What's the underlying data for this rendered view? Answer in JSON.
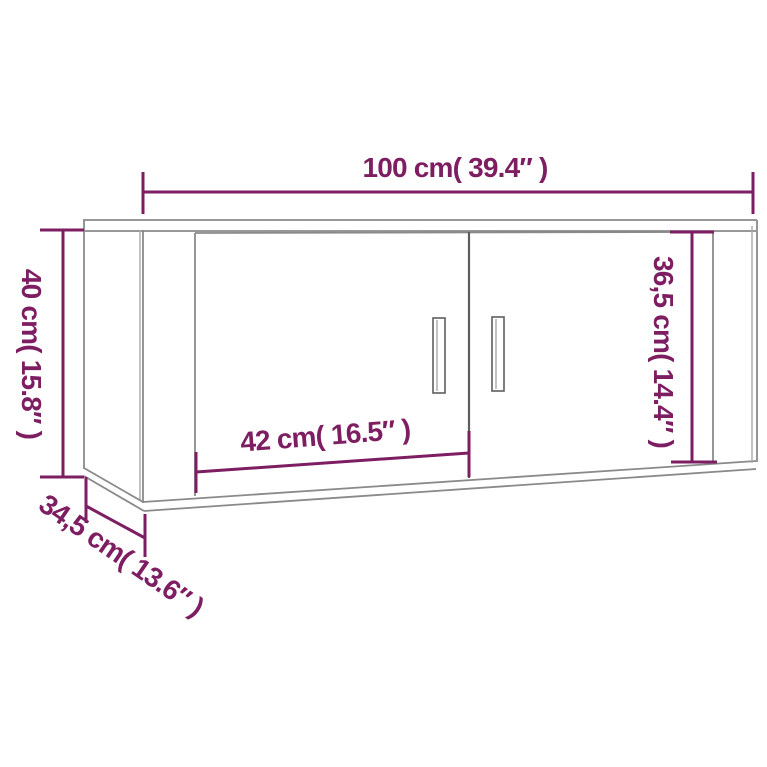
{
  "image": {
    "title": "Wall cabinet dimension diagram",
    "background": "#ffffff"
  },
  "colors": {
    "accent": "#7e1e62",
    "outline": "#8a8a8a",
    "outline_dark": "#5e5e5e"
  },
  "dimensions": {
    "width": {
      "label": "100 cm( 39.4″ )"
    },
    "height": {
      "label": "40 cm( 15.8″ )"
    },
    "door_height": {
      "label": "36,5 cm( 14.4″ )"
    },
    "door_width": {
      "label": "42 cm( 16.5″ )"
    },
    "depth": {
      "label": "34,5 cm( 13.6″ )"
    }
  }
}
